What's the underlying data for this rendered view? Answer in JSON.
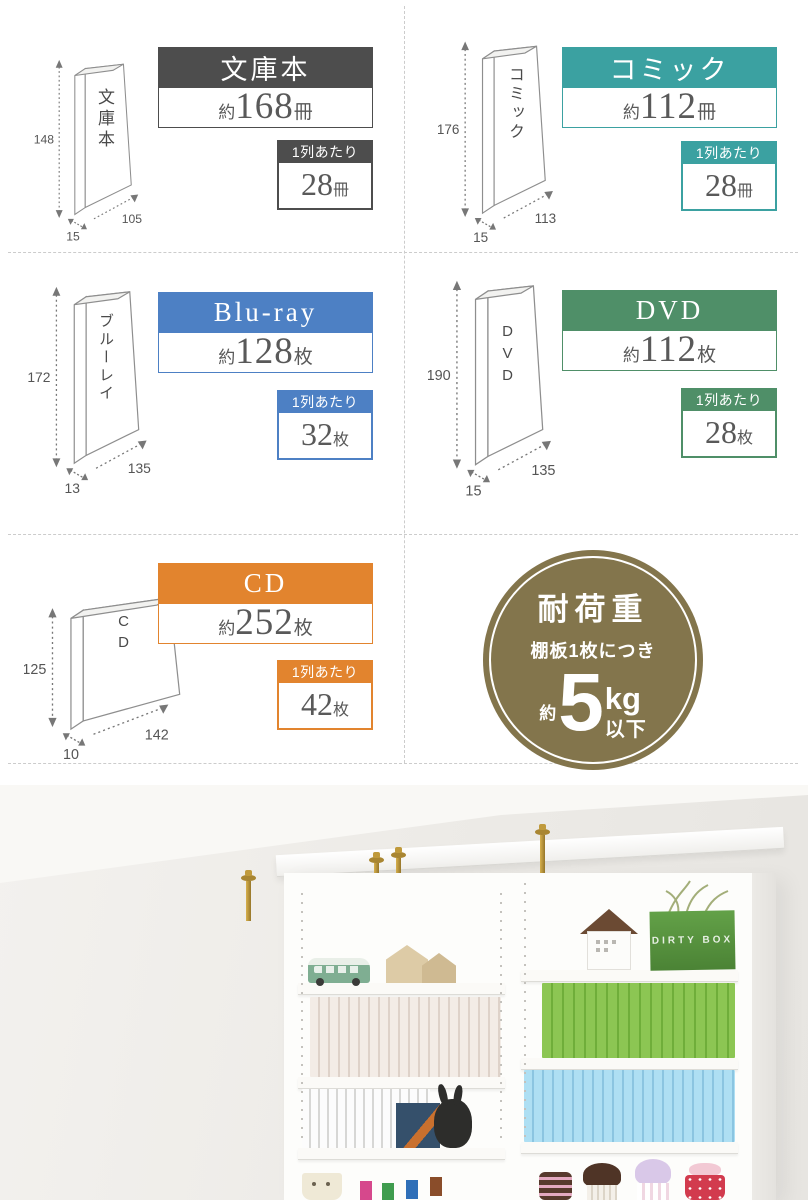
{
  "section_capacity": {
    "cards": [
      {
        "key": "bunkobon",
        "header": "文庫本",
        "vertical_label": "文庫本",
        "accent": "#4d4d4d",
        "total_prefix": "約",
        "total_value": "168",
        "total_unit": "冊",
        "per_row_label": "1列あたり",
        "per_row_value": "28",
        "per_row_unit": "冊",
        "dim_height": "148",
        "dim_depth": "105",
        "dim_thickness": "15"
      },
      {
        "key": "comic",
        "header": "コミック",
        "vertical_label": "コミック",
        "accent": "#3ba1a1",
        "total_prefix": "約",
        "total_value": "112",
        "total_unit": "冊",
        "per_row_label": "1列あたり",
        "per_row_value": "28",
        "per_row_unit": "冊",
        "dim_height": "176",
        "dim_depth": "113",
        "dim_thickness": "15"
      },
      {
        "key": "bluray",
        "header": "Blu-ray",
        "vertical_label": "ブルーレイ",
        "accent": "#4d80c4",
        "total_prefix": "約",
        "total_value": "128",
        "total_unit": "枚",
        "per_row_label": "1列あたり",
        "per_row_value": "32",
        "per_row_unit": "枚",
        "dim_height": "172",
        "dim_depth": "135",
        "dim_thickness": "13"
      },
      {
        "key": "dvd",
        "header": "DVD",
        "vertical_label": "DVD",
        "accent": "#4f8f68",
        "total_prefix": "約",
        "total_value": "112",
        "total_unit": "枚",
        "per_row_label": "1列あたり",
        "per_row_value": "28",
        "per_row_unit": "枚",
        "dim_height": "190",
        "dim_depth": "135",
        "dim_thickness": "15"
      },
      {
        "key": "cd",
        "header": "CD",
        "vertical_label": "CD",
        "accent": "#e2842e",
        "total_prefix": "約",
        "total_value": "252",
        "total_unit": "枚",
        "per_row_label": "1列あたり",
        "per_row_value": "42",
        "per_row_unit": "枚",
        "dim_height": "125",
        "dim_depth": "142",
        "dim_thickness": "10"
      }
    ]
  },
  "load_badge": {
    "title": "耐荷重",
    "subtitle": "棚板1枚につき",
    "approx": "約",
    "value": "5",
    "unit": "kg",
    "suffix": "以下",
    "color": "#83754c"
  },
  "photo": {
    "crate_text": "DIRTY BOX"
  }
}
